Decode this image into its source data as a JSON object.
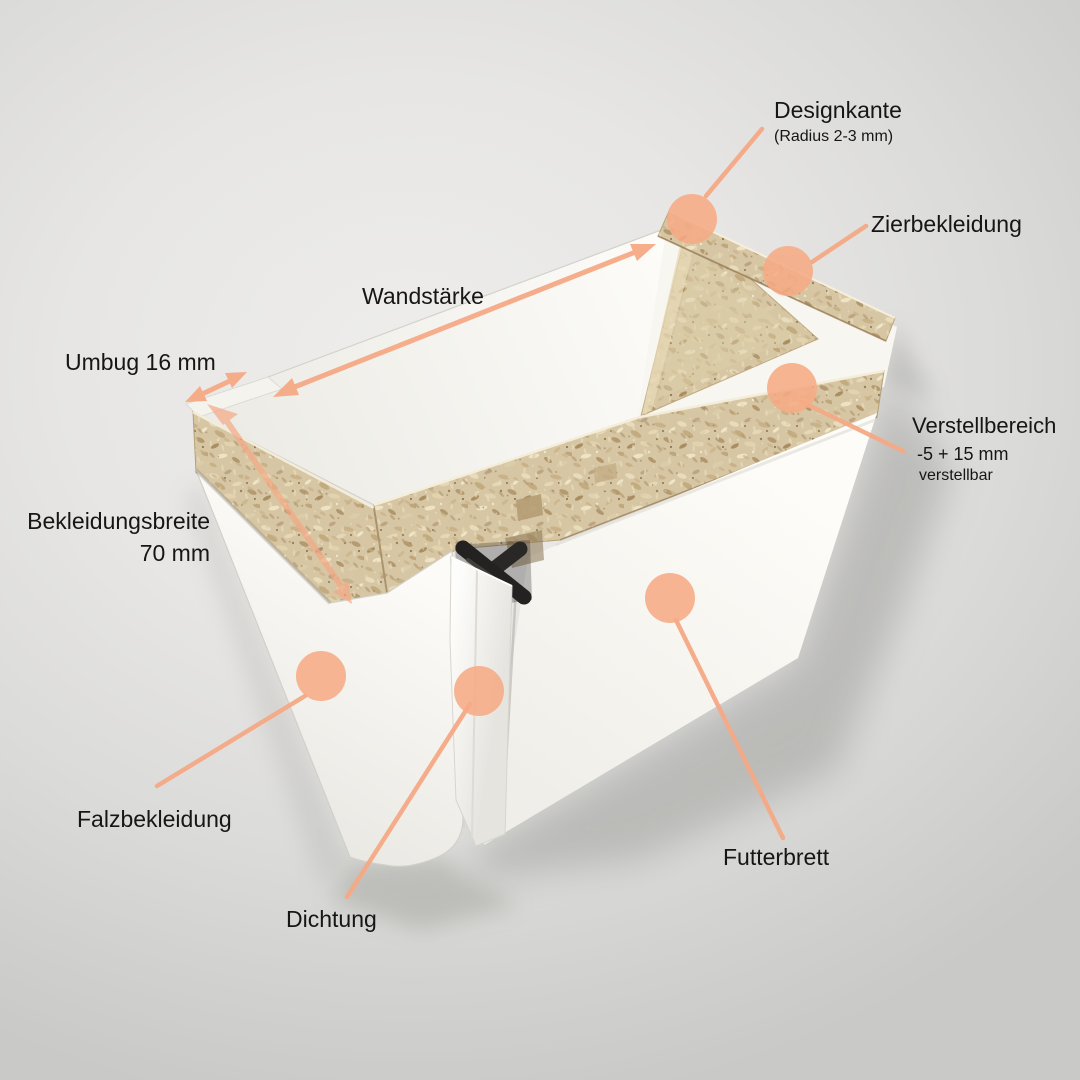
{
  "colors": {
    "accent_peach": "#f5a985",
    "chipboard_base": "#d6c6a4",
    "panel_white": "#fbf9f4",
    "seal_black": "#262422",
    "background": "#e7e6e4",
    "text": "#161616"
  },
  "labels": {
    "designkante": {
      "text": "Designkante",
      "subtext": "(Radius 2-3 mm)"
    },
    "zierbekleidung": {
      "text": "Zierbekleidung"
    },
    "wandstaerke": {
      "text": "Wandstärke"
    },
    "umbug": {
      "text": "Umbug 16 mm"
    },
    "bekleidungsbreite": {
      "text": "Bekleidungsbreite",
      "subtext": "70 mm"
    },
    "verstellbereich": {
      "text": "Verstellbereich",
      "subtext": "-5 + 15 mm",
      "subtext2": "verstellbar"
    },
    "falzbekleidung": {
      "text": "Falzbekleidung"
    },
    "dichtung": {
      "text": "Dichtung"
    },
    "futterbrett": {
      "text": "Futterbrett"
    }
  }
}
